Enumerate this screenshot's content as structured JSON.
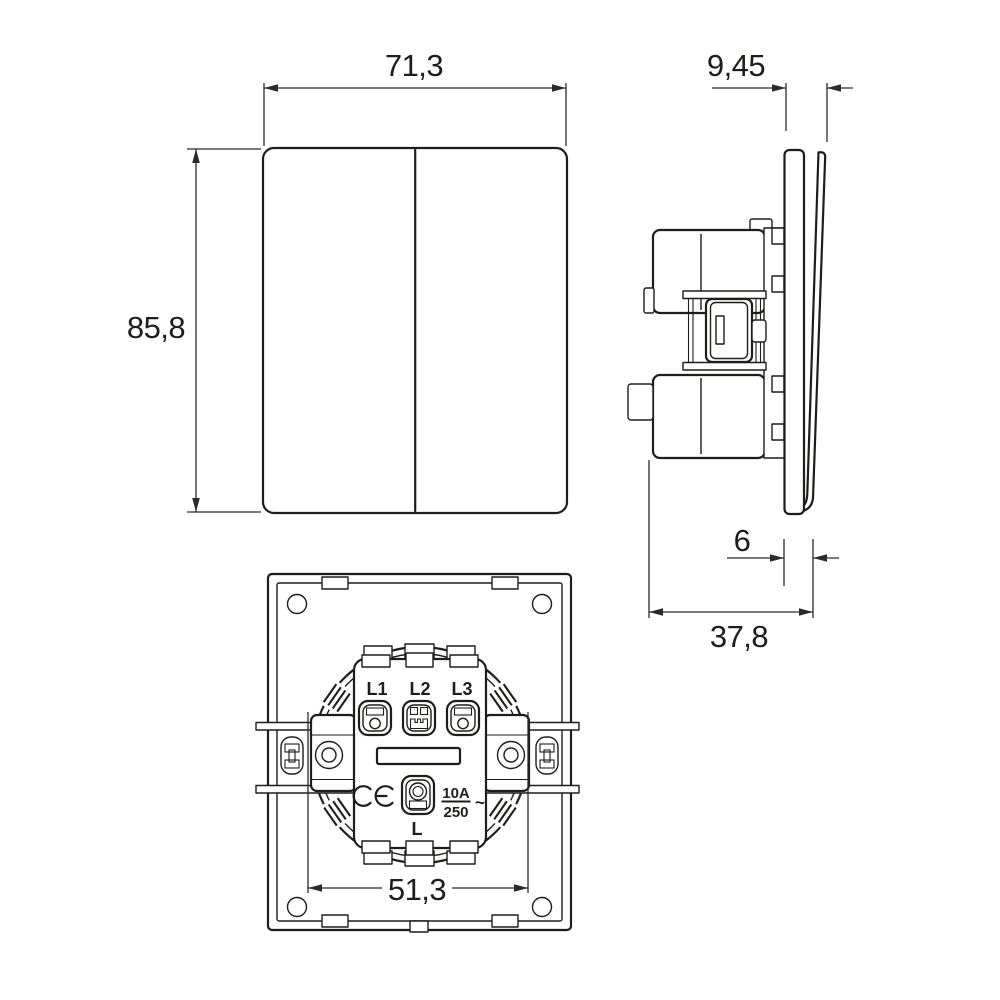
{
  "drawing": {
    "type": "technical-dimension-drawing",
    "subject": "2-gang rocker wall switch",
    "colors": {
      "line": "#1d1d1b",
      "dim": "#2b2b2b",
      "background": "#ffffff"
    },
    "front_view": {
      "width_label": "71,3",
      "height_label": "85,8"
    },
    "side_view": {
      "rocker_depth_label": "9,45",
      "cover_depth_label": "6",
      "total_depth_label": "37,8"
    },
    "back_view": {
      "claw_span_label": "51,3",
      "terminal_labels": [
        "L1",
        "L2",
        "L3"
      ],
      "line_terminal_label": "L",
      "rating": {
        "current": "10A",
        "voltage": "250",
        "ac_symbol": "~"
      },
      "ce_mark": "CE"
    }
  }
}
